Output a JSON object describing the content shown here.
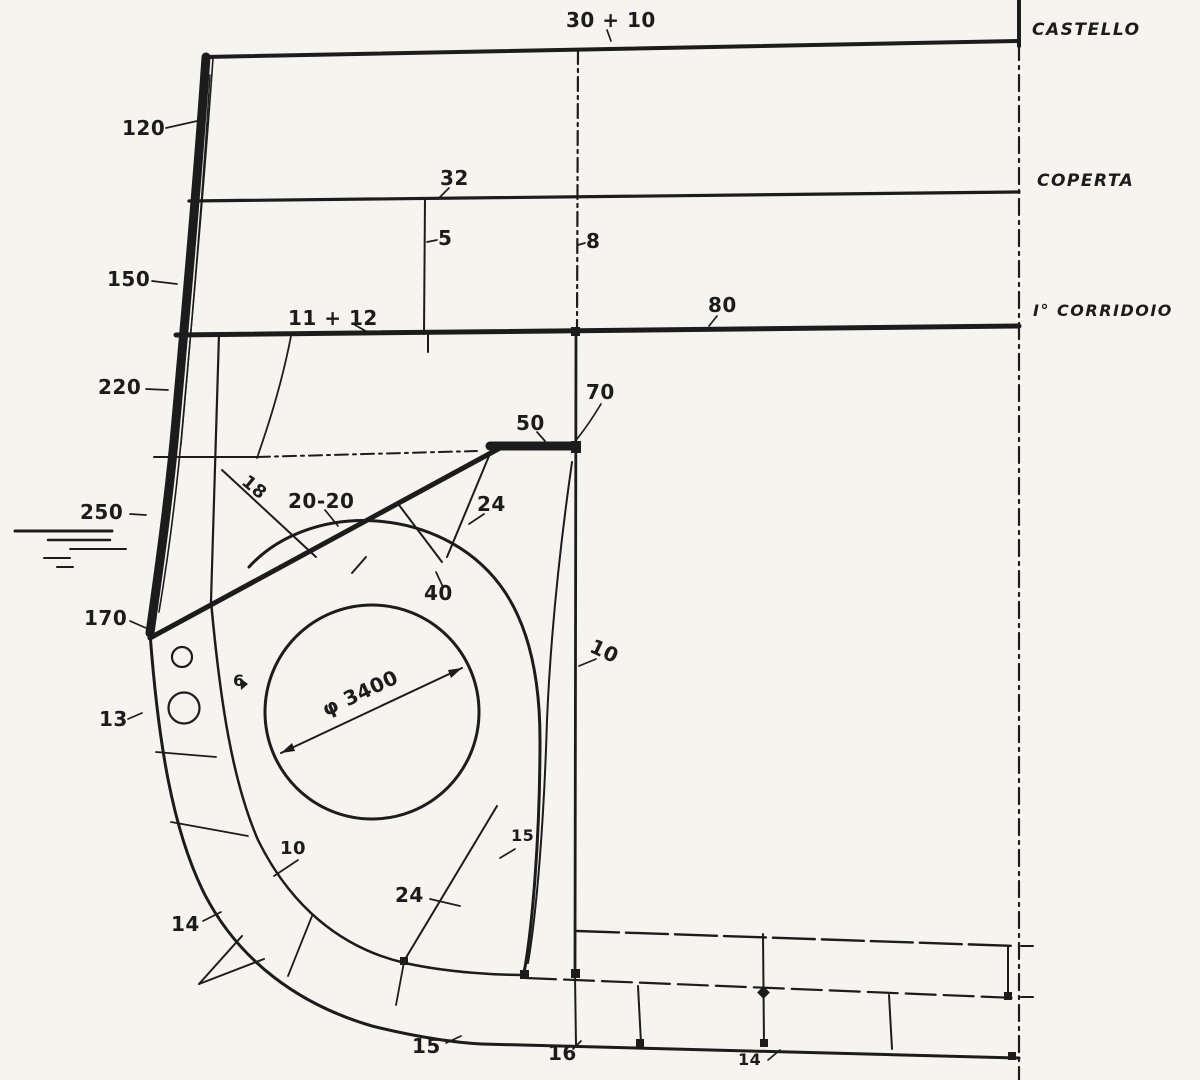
{
  "colors": {
    "ink": "#1c1c1c",
    "paper": "#f6f4ef"
  },
  "labels": {
    "dim_30_10": "30 + 10",
    "deck_castello": "CASTELLO",
    "dim_120": "120",
    "dim_32": "32",
    "deck_coperta": "COPERTA",
    "dim_5": "5",
    "dim_8": "8",
    "dim_150": "150",
    "dim_11_12": "11 + 12",
    "dim_80": "80",
    "deck_corridoio": "I° CORRIDOIO",
    "dim_220": "220",
    "dim_70": "70",
    "dim_50": "50",
    "dim_18": "18",
    "dim_20_20": "20-20",
    "dim_24_upper": "24",
    "dim_250": "250",
    "dim_40": "40",
    "dim_170": "170",
    "dim_10_bulkhead": "10",
    "dim_13": "13",
    "dim_6": "6",
    "dim_phi": "φ 3400",
    "dim_15_upper": "15",
    "dim_10_bilge": "10",
    "dim_24_lower": "24",
    "dim_14_side": "14",
    "dim_15_bottom": "15",
    "dim_16": "16",
    "dim_14_bottom": "14"
  }
}
